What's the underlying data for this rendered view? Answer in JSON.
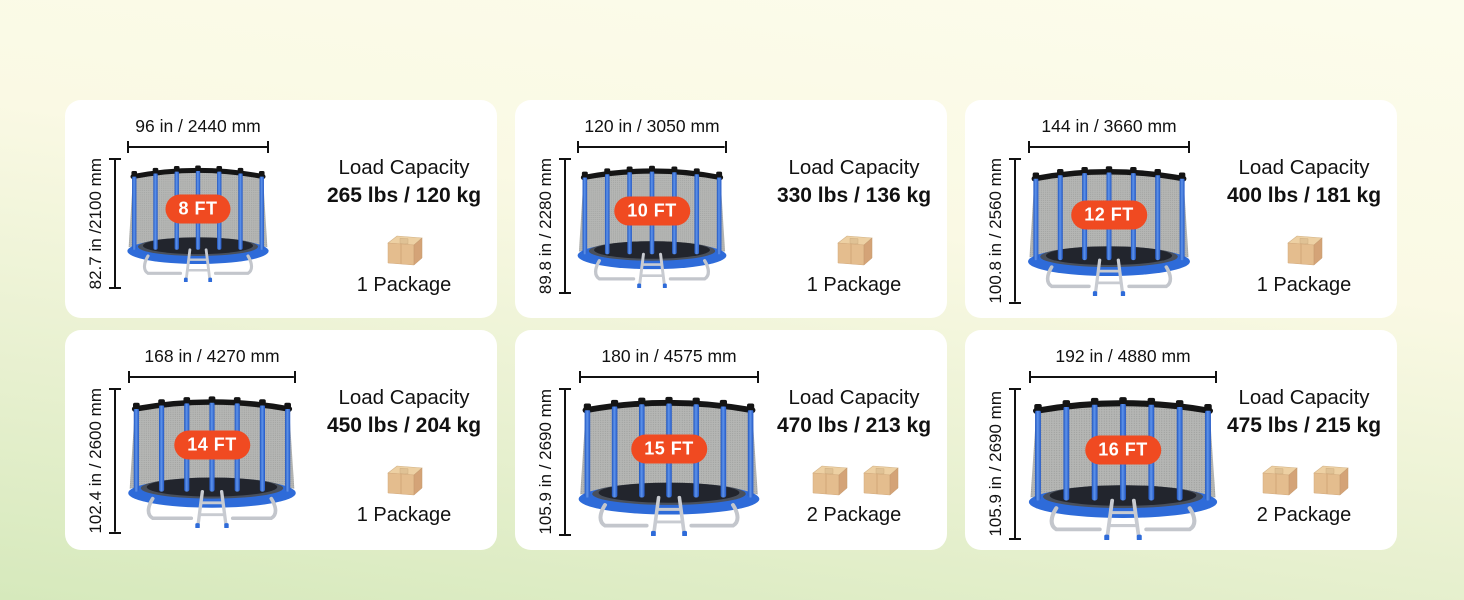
{
  "cards": [
    {
      "size_label": "8 FT",
      "width_dimension": "96 in / 2440 mm",
      "height_dimension": "82.7 in /2100 mm",
      "load_capacity_label": "Load Capacity",
      "load_capacity_value": "265 lbs / 120 kg",
      "package_label": "1 Package",
      "package_count": 1
    },
    {
      "size_label": "10 FT",
      "width_dimension": "120 in / 3050 mm",
      "height_dimension": "89.8 in / 2280 mm",
      "load_capacity_label": "Load Capacity",
      "load_capacity_value": "330 lbs / 136 kg",
      "package_label": "1 Package",
      "package_count": 1
    },
    {
      "size_label": "12 FT",
      "width_dimension": "144 in / 3660 mm",
      "height_dimension": "100.8 in / 2560 mm",
      "load_capacity_label": "Load Capacity",
      "load_capacity_value": "400 lbs / 181 kg",
      "package_label": "1 Package",
      "package_count": 1
    },
    {
      "size_label": "14 FT",
      "width_dimension": "168 in / 4270 mm",
      "height_dimension": "102.4 in / 2600 mm",
      "load_capacity_label": "Load Capacity",
      "load_capacity_value": "450 lbs / 204 kg",
      "package_label": "1 Package",
      "package_count": 1
    },
    {
      "size_label": "15 FT",
      "width_dimension": "180 in / 4575 mm",
      "height_dimension": "105.9 in / 2690 mm",
      "load_capacity_label": "Load Capacity",
      "load_capacity_value": "470 lbs / 213 kg",
      "package_label": "2 Package",
      "package_count": 2
    },
    {
      "size_label": "16 FT",
      "width_dimension": "192 in / 4880 mm",
      "height_dimension": "105.9 in / 2690 mm",
      "load_capacity_label": "Load Capacity",
      "load_capacity_value": "475 lbs / 215 kg",
      "package_label": "2 Package",
      "package_count": 2
    }
  ],
  "icons": {
    "package_box": "package-box-icon",
    "size_badge": "size-badge"
  },
  "colors": {
    "background_top": "#FAFAE8",
    "background_bottom": "#D6E9BC",
    "card_background": "#FFFFFF",
    "badge_background": "#F04A21",
    "badge_text": "#FFFFFF",
    "pole_blue": "#2E6BD9",
    "net_gray": "#B5B6B4",
    "mat_dark": "#22252D",
    "frame_silver": "#C3C6CC",
    "box_tan": "#E4BD8E",
    "dimension_text": "#111111"
  }
}
